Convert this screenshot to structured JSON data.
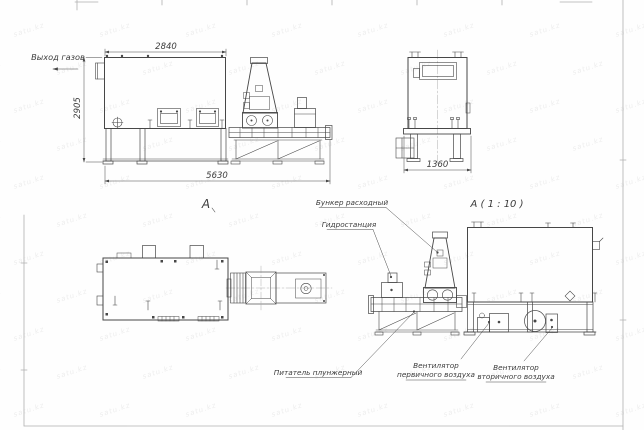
{
  "sheet": {
    "watermark_text": "satu.kz",
    "colors": {
      "ink": "#474747",
      "frame": "#b0b0b0",
      "watermark": "rgba(90,90,90,0.10)",
      "background": "#fefefe"
    }
  },
  "views": {
    "front_elevation": {
      "gas_outlet_label": "Выход газов",
      "view_letter": "А",
      "dim_width_top": "2840",
      "dim_height": "2905",
      "dim_width_total": "5630"
    },
    "end_view": {
      "dim_width": "1360"
    },
    "detail_view": {
      "title": "А ( 1 : 10 )",
      "callout_bunker": "Бункер расходный",
      "callout_hydro": "Гидростанция",
      "callout_feeder": "Питатель плунжерный",
      "callout_fan_primary_line1": "Вентилятор",
      "callout_fan_primary_line2": "первичного воздуха",
      "callout_fan_secondary_line1": "Вентилятор",
      "callout_fan_secondary_line2": "вторичного воздуха"
    }
  }
}
